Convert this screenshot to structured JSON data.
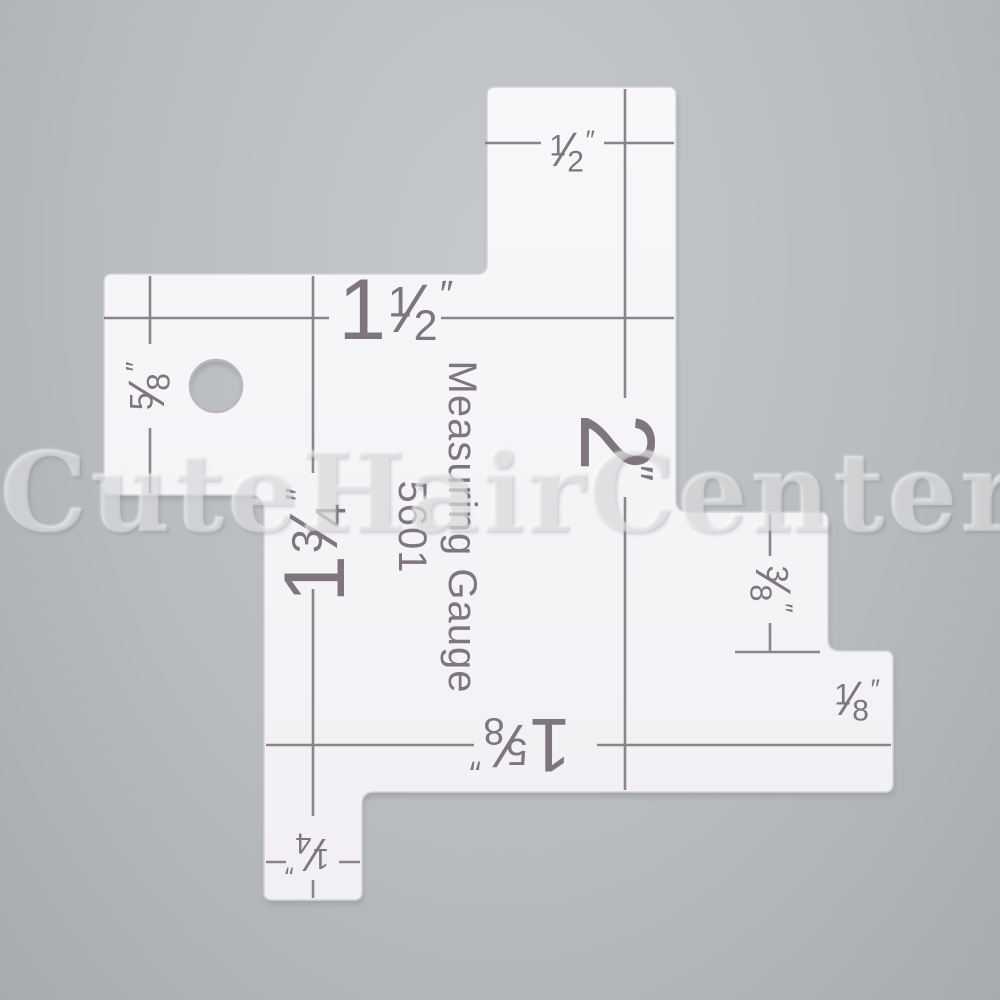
{
  "product": {
    "title": "Measuring Gauge",
    "model": "5601"
  },
  "watermark": "CuteHairCenter",
  "colors": {
    "background": "#b9bcbf",
    "acrylic": "#f5f5f7",
    "engraving": "#7e767c",
    "watermark": "rgba(255,255,255,0.30)"
  },
  "labels": {
    "top_half": {
      "whole": "",
      "num": "1",
      "slash": "⁄",
      "den": "2",
      "unit": "″"
    },
    "one_and_half": {
      "whole": "1",
      "num": "1",
      "slash": "⁄",
      "den": "2",
      "unit": "″"
    },
    "five_eighths": {
      "whole": "",
      "num": "5",
      "slash": "⁄",
      "den": "8",
      "unit": "″"
    },
    "two_inch": {
      "whole": "2",
      "num": "",
      "slash": "",
      "den": "",
      "unit": "″"
    },
    "one_three_quarters": {
      "whole": "1",
      "num": "3",
      "slash": "⁄",
      "den": "4",
      "unit": "″"
    },
    "three_eighths": {
      "whole": "",
      "num": "3",
      "slash": "⁄",
      "den": "8",
      "unit": "″"
    },
    "one_eighth": {
      "whole": "",
      "num": "1",
      "slash": "⁄",
      "den": "8",
      "unit": "″"
    },
    "one_five_eighths": {
      "whole": "1",
      "num": "5",
      "slash": "⁄",
      "den": "8",
      "unit": "″"
    },
    "one_quarter": {
      "whole": "",
      "num": "1",
      "slash": "⁄",
      "den": "4",
      "unit": "″"
    }
  }
}
